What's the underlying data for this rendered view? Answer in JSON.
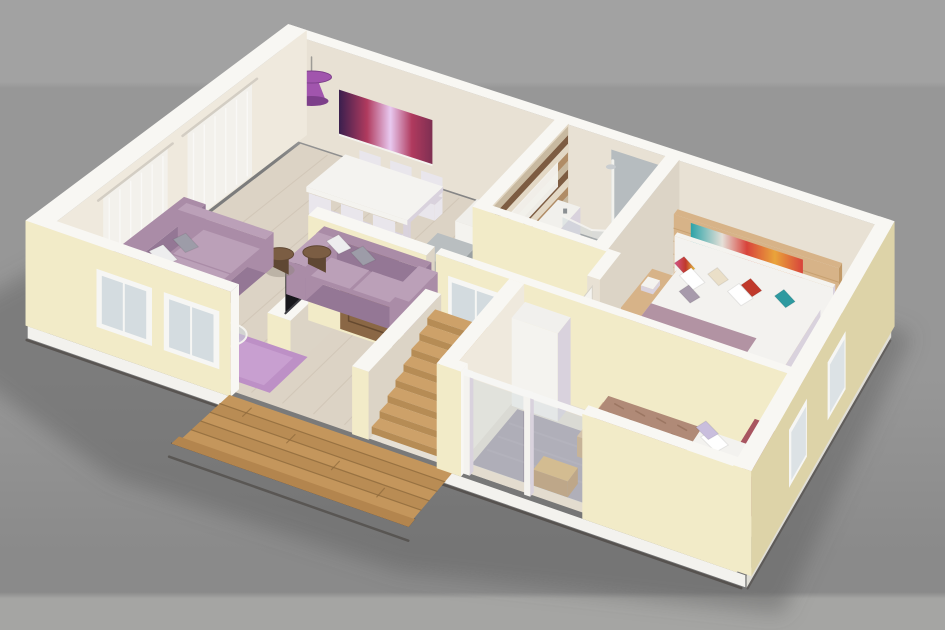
{
  "scene": {
    "type": "3d-floorplan-render",
    "description": "Isometric 3D cutaway render of an apartment floor plan photographed on a gray studio backdrop. Open living-dining room with two mauve sofas, lilac rug, glass coffee table, white dining set, purple pendant lamp and purple panoramic wall art; tiled bathroom with curved-glass corner shower and wood-strip feature wall; master bedroom with platform bed, colorful abstract art and green rug; small bedroom with single bed, gray rug and glass balustrade; timber entry deck, wooden front door and staircase.",
    "rooms": [
      {
        "name": "living-dining-room",
        "contents": [
          "mauve three-seat sofa",
          "mauve two-seat sofa",
          "white and gray throw pillows",
          "two brown drum side tables",
          "lilac rug",
          "round glass coffee table",
          "orange bowl",
          "white dining table",
          "six white chairs",
          "purple drum pendant lamp",
          "panoramic purple wall art",
          "sheer white curtains",
          "flat tv on half wall"
        ]
      },
      {
        "name": "kitchenette",
        "contents": [
          "gray counter block",
          "white cabinet"
        ]
      },
      {
        "name": "bathroom",
        "contents": [
          "corner shower with curved glass",
          "gray tiled shower walls",
          "wood-strip mosaic feature wall",
          "white vanity shelf",
          "brown mosaic tile floor"
        ]
      },
      {
        "name": "master-bedroom",
        "contents": [
          "wooden platform double bed",
          "white headboard panel",
          "colorful abstract painting",
          "floating nightstand ledges",
          "patterned accent pillows",
          "mauve blanket",
          "green textured rug",
          "yellow-pink armchair",
          "mauve pouf",
          "bench with red throw",
          "white open door"
        ]
      },
      {
        "name": "small-bedroom",
        "contents": [
          "single bed with tan patterned duvet",
          "white and lavender pillows",
          "carved red headboard",
          "gray rug",
          "white wardrobe",
          "wooden stool",
          "glass balustrade window"
        ]
      },
      {
        "name": "entry-hall",
        "contents": [
          "wooden front door",
          "timber deck",
          "wooden staircase",
          "frosted window panel"
        ]
      }
    ]
  },
  "palette": {
    "bg-top": "#a2a2a2",
    "bg-mid": "#979797",
    "bg-bottom": "#8a8a8a",
    "bg-band": "#a5a5a3",
    "shadow": "#5c5c5c",
    "slab": "#f3f2ee",
    "slab-shade": "#e0ded6",
    "base-line": "#3c3530",
    "wall-top": "#f8f7f3",
    "ext-lit": "#f2ebc8",
    "ext-shade": "#ddd3a8",
    "ext-dark": "#cfc49a",
    "int-wall": "#e8e1d4",
    "int-wall-2": "#efe9dd",
    "int-wall-shade": "#dcd4c6",
    "floor-wood": "#dcd3c5",
    "floor-line": "#c8bcab",
    "floor-tile": "#e6e0d5",
    "floor-bed": "#e3dccf",
    "mosaic-base": "#cfc2ae",
    "mosaic-a": "#9d7c5b",
    "mosaic-b": "#f0e9d8",
    "mosaic-c": "#7b5a40",
    "stripe-a": "#b08c66",
    "stripe-b": "#e3d8c5",
    "stripe-c": "#7d5c42",
    "stripe-d": "#c8b9a0",
    "deck-wood": "#c4965c",
    "deck-wood-2": "#b3854e",
    "deck-line": "#8f6a3c",
    "deck-edge": "#33241a",
    "stair-wood": "#cda169",
    "stair-riser": "#b68c55",
    "sofa": "#aa8ca7",
    "sofa-light": "#bba0b8",
    "sofa-dark": "#947795",
    "cushion-a": "#ededee",
    "cushion-b": "#9d9ca8",
    "rug-lilac": "#bd90c6",
    "rug-lilac-2": "#d4aeda",
    "drum": "#5f4733",
    "drum-top": "#7b5d43",
    "lamp": "#a155ad",
    "lamp-dark": "#7d3f8a",
    "tv": "#17171b",
    "door": "#8a6745",
    "door-dark": "#65492f",
    "glass": "#ccd6db",
    "frame": "#f6f6f4",
    "table-white": "#f4f3f0",
    "chair": "#e9e6ec",
    "chair-seat": "#d9d2dd",
    "counter": "#9aa0a2",
    "counter-top": "#b9bec0",
    "cabinet": "#f0efeb",
    "shower-wall": "#b6bcbf",
    "shower-wall-2": "#a6adb1",
    "shower-base": "#e7e8e4",
    "vanity": "#f1f0ec",
    "bed-wood": "#d7b388",
    "bed-wood-dark": "#c29a68",
    "bedding": "#f3f2ef",
    "blanket": "#b293a3",
    "pillow-gray": "#a79aab",
    "p-red": "#c0392b",
    "p-teal": "#2e9aa0",
    "p-cream": "#eadfc8",
    "art1-a": "#3a1f4e",
    "art1-b": "#b03a5e",
    "art1-c": "#e8c9f0",
    "art1-d": "#7e2f52",
    "art2-a": "#2ba3a8",
    "art2-b": "#d8433b",
    "art2-c": "#e9a43a",
    "art2-d": "#e5e0d8",
    "rug-green": "#8d9168",
    "rug-green-dark": "#757953",
    "chair-yellow": "#e9c23f",
    "chair-pink": "#d4558a",
    "bench-cloth": "#c34a5e",
    "bench-cloth-2": "#e06a7e",
    "pouf": "#b49ac0",
    "duvet-tan": "#b08a77",
    "duvet-pattern": "#96705d",
    "pillow-lav": "#c9bedd",
    "headboard-red": "#8e3b45",
    "headboard-red-2": "#a85560",
    "rug-gray": "#9b93a0",
    "rug-gray-2": "#aaa2ae",
    "wardrobe": "#f1f0ed",
    "stool": "#d8a95c",
    "white": "#ffffff",
    "near-white": "#f4f3ef"
  }
}
